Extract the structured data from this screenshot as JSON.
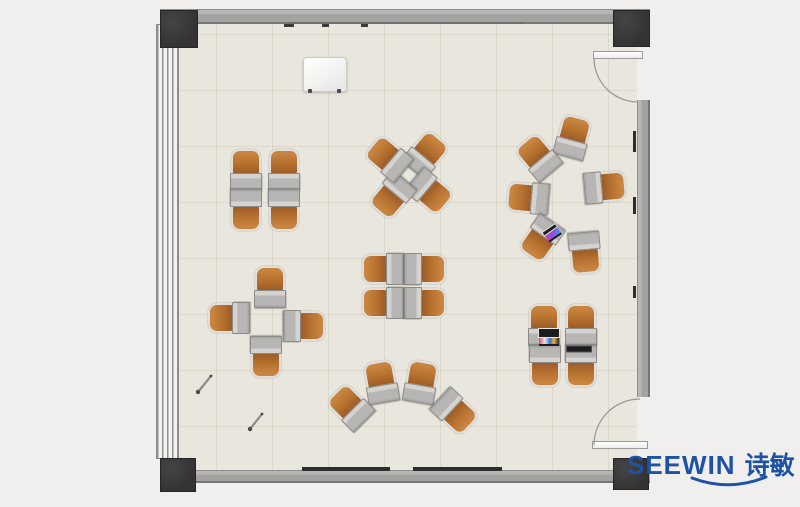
{
  "brand": {
    "name": "SEEWIN",
    "name_cn": "诗敏",
    "color": "#1d52a4"
  },
  "palette": {
    "outside": "#f0efed",
    "floor": "#e9e6dd",
    "wall": "#a9a8a6",
    "pillar": "#3a3a3a",
    "chair_orange": "#bd7a3e",
    "desk_gray": "#b9b8b6",
    "mark_dark": "#2c2c2c"
  },
  "room": {
    "type": "classroom-floor-plan",
    "walls": [
      {
        "ori": "h",
        "x": 160,
        "y": 9,
        "w": 490,
        "h": 15
      },
      {
        "ori": "h",
        "x": 160,
        "y": 470,
        "w": 490,
        "h": 13
      },
      {
        "ori": "v",
        "x": 637,
        "y": 100,
        "w": 13,
        "h": 297
      }
    ],
    "pillars": [
      {
        "x": 160,
        "y": 10,
        "w": 38,
        "h": 38
      },
      {
        "x": 613,
        "y": 10,
        "w": 37,
        "h": 37
      },
      {
        "x": 160,
        "y": 458,
        "w": 36,
        "h": 34
      },
      {
        "x": 613,
        "y": 458,
        "w": 36,
        "h": 32
      }
    ],
    "window": {
      "x": 156,
      "y": 24,
      "w": 23,
      "h": 435
    },
    "doors": [
      {
        "leaf": {
          "x": 593,
          "y": 51,
          "w": 50,
          "h": 8
        },
        "arc": "M594 58 A44 44 0 0 0 638 102"
      },
      {
        "leaf": {
          "x": 592,
          "y": 441,
          "w": 56,
          "h": 8
        },
        "arc": "M594 445 A46 46 0 0 1 640 399"
      }
    ],
    "wall_marks": [
      {
        "x": 290,
        "y": 22,
        "w": 233,
        "h": 2,
        "color": "#6e6e6c"
      },
      {
        "x": 284,
        "y": 24,
        "w": 10,
        "h": 3,
        "color": "#3c3c3c"
      },
      {
        "x": 322,
        "y": 24,
        "w": 7,
        "h": 3,
        "color": "#3c3c3c"
      },
      {
        "x": 361,
        "y": 24,
        "w": 7,
        "h": 3,
        "color": "#3c3c3c"
      },
      {
        "x": 302,
        "y": 467,
        "w": 88,
        "h": 4,
        "color": "#2c2c2c"
      },
      {
        "x": 413,
        "y": 467,
        "w": 89,
        "h": 4,
        "color": "#2c2c2c"
      },
      {
        "x": 633,
        "y": 131,
        "w": 3,
        "h": 21,
        "color": "#2c2c2c"
      },
      {
        "x": 633,
        "y": 197,
        "w": 3,
        "h": 17,
        "color": "#2c2c2c"
      },
      {
        "x": 633,
        "y": 286,
        "w": 3,
        "h": 12,
        "color": "#2c2c2c"
      }
    ]
  },
  "furniture": {
    "units": [
      {
        "x": 246,
        "y": 170,
        "r": 0,
        "cluster": "top-left-grid"
      },
      {
        "x": 284,
        "y": 170,
        "r": 0,
        "cluster": "top-left-grid"
      },
      {
        "x": 246,
        "y": 210,
        "r": 180,
        "cluster": "top-left-grid"
      },
      {
        "x": 284,
        "y": 210,
        "r": 180,
        "cluster": "top-left-grid"
      },
      {
        "x": 426,
        "y": 154,
        "r": 40,
        "cluster": "top-center-pinwheel"
      },
      {
        "x": 430,
        "y": 192,
        "r": 130,
        "cluster": "top-center-pinwheel"
      },
      {
        "x": 392,
        "y": 196,
        "r": 220,
        "cluster": "top-center-pinwheel"
      },
      {
        "x": 388,
        "y": 158,
        "r": -50,
        "cluster": "top-center-pinwheel"
      },
      {
        "x": 573,
        "y": 137,
        "r": 15,
        "cluster": "right-ring"
      },
      {
        "x": 538,
        "y": 157,
        "r": -40,
        "cluster": "right-ring"
      },
      {
        "x": 605,
        "y": 187,
        "r": 85,
        "cluster": "right-ring"
      },
      {
        "x": 528,
        "y": 198,
        "r": -85,
        "cluster": "right-ring"
      },
      {
        "x": 541,
        "y": 239,
        "r": -145,
        "cluster": "right-ring"
      },
      {
        "x": 585,
        "y": 253,
        "r": 175,
        "cluster": "right-ring"
      },
      {
        "x": 270,
        "y": 287,
        "r": 0,
        "cluster": "left-cross"
      },
      {
        "x": 229,
        "y": 318,
        "r": -90,
        "cluster": "left-cross"
      },
      {
        "x": 304,
        "y": 326,
        "r": 90,
        "cluster": "left-cross"
      },
      {
        "x": 266,
        "y": 357,
        "r": 180,
        "cluster": "left-cross"
      },
      {
        "x": 383,
        "y": 269,
        "r": -90,
        "cluster": "center-grid"
      },
      {
        "x": 425,
        "y": 269,
        "r": 90,
        "cluster": "center-grid"
      },
      {
        "x": 383,
        "y": 303,
        "r": -90,
        "cluster": "center-grid"
      },
      {
        "x": 425,
        "y": 303,
        "r": 90,
        "cluster": "center-grid"
      },
      {
        "x": 350,
        "y": 407,
        "r": -45,
        "cluster": "bottom-fan"
      },
      {
        "x": 381,
        "y": 382,
        "r": -10,
        "cluster": "bottom-fan"
      },
      {
        "x": 421,
        "y": 382,
        "r": 10,
        "cluster": "bottom-fan"
      },
      {
        "x": 455,
        "y": 412,
        "r": 133,
        "cluster": "bottom-fan"
      },
      {
        "x": 544,
        "y": 325,
        "r": 0,
        "cluster": "bottom-right-grid"
      },
      {
        "x": 581,
        "y": 325,
        "r": 0,
        "cluster": "bottom-right-grid"
      },
      {
        "x": 545,
        "y": 366,
        "r": 180,
        "cluster": "bottom-right-grid"
      },
      {
        "x": 581,
        "y": 366,
        "r": 180,
        "cluster": "bottom-right-grid"
      }
    ],
    "podium": {
      "x": 303,
      "y": 57,
      "w": 42,
      "h": 33
    },
    "laptops": [
      {
        "x": 552,
        "y": 233,
        "rot": -35,
        "type": "open-small"
      },
      {
        "x": 549,
        "y": 337,
        "rot": 0,
        "type": "open"
      },
      {
        "x": 579,
        "y": 349,
        "rot": 0,
        "type": "closed"
      }
    ],
    "sticks": [
      {
        "x1": 198,
        "y1": 392,
        "x2": 211,
        "y2": 376
      },
      {
        "x1": 250,
        "y1": 429,
        "x2": 262,
        "y2": 414
      }
    ]
  }
}
